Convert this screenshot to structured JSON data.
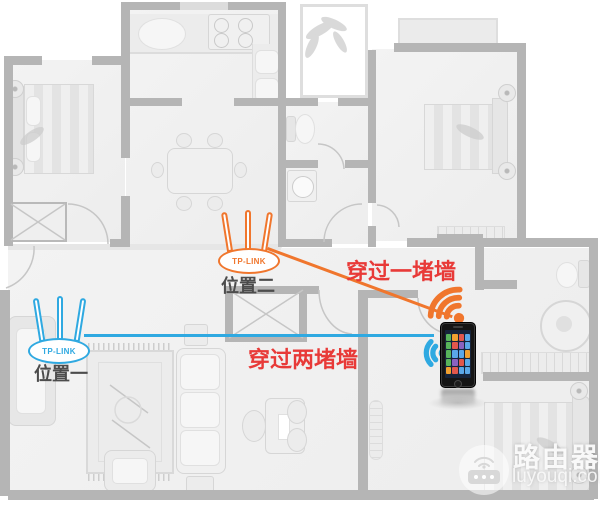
{
  "diagram": {
    "annotations": {
      "one_wall": "穿过一堵墙",
      "two_walls": "穿过两堵墙"
    },
    "routers": {
      "brand": "TP-LINK",
      "position1_label": "位置一",
      "position2_label": "位置二"
    }
  },
  "watermark": {
    "title": "路由器",
    "domain": "luyouqi.com"
  },
  "colors": {
    "orange": "#f0762d",
    "blue": "#2fa9e1",
    "red": "#e83a38",
    "wall": "#b5b5b5",
    "label": "#4c4c4c"
  }
}
